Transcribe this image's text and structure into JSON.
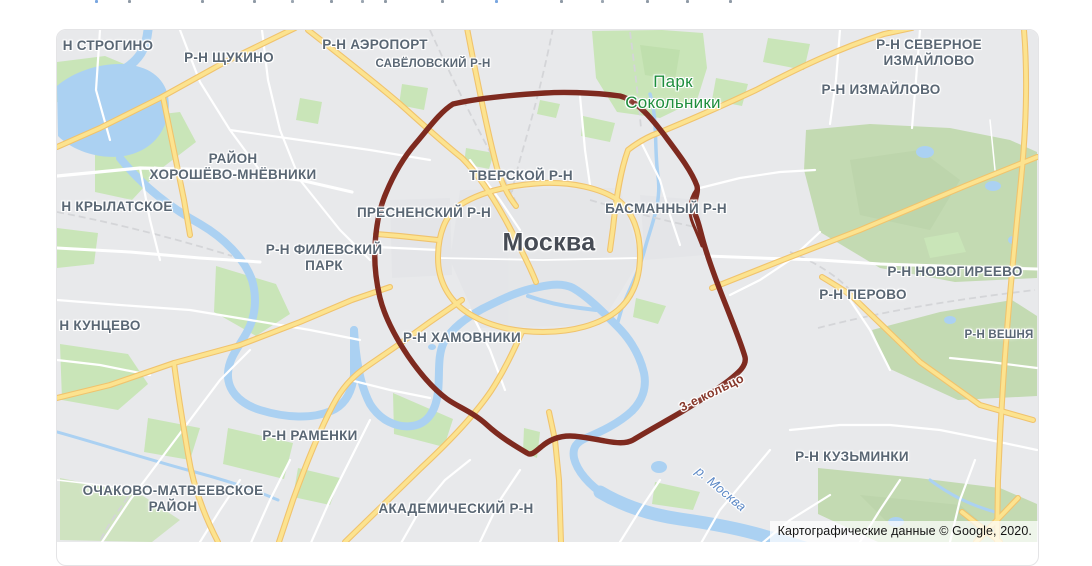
{
  "page": {
    "background": "#ffffff",
    "clipped_top_text_fragments": [
      {
        "x": 95,
        "color": "#79a6e0"
      },
      {
        "x": 128,
        "color": "#8e99a5"
      },
      {
        "x": 201,
        "color": "#8e99a5"
      },
      {
        "x": 253,
        "color": "#8e99a5"
      },
      {
        "x": 291,
        "color": "#9aa5b0"
      },
      {
        "x": 330,
        "color": "#8e99a5"
      },
      {
        "x": 361,
        "color": "#9aa5b0"
      },
      {
        "x": 384,
        "color": "#8e99a5"
      },
      {
        "x": 441,
        "color": "#8e99a5"
      },
      {
        "x": 495,
        "color": "#79a6e0"
      },
      {
        "x": 560,
        "color": "#8e99a5"
      },
      {
        "x": 601,
        "color": "#9aa5b0"
      },
      {
        "x": 646,
        "color": "#8e99a5"
      },
      {
        "x": 686,
        "color": "#8e99a5"
      },
      {
        "x": 729,
        "color": "#8e99a5"
      }
    ]
  },
  "map": {
    "attribution": "Картографические данные © Google, 2020.",
    "colors": {
      "land": "#e8e9eb",
      "water": "#abd1f2",
      "park": "#c9e5b8",
      "forest": "#c3dab2",
      "road_major_fill": "#fce38f",
      "road_major_casing": "#f0c36d",
      "road_minor": "#ffffff",
      "ring_road": "#7e2a1f",
      "district_label": "#5a6774",
      "city_label": "#474c55",
      "park_label": "#1f8e3d",
      "river_label": "#5d89c6",
      "ring_label": "#87382b"
    },
    "labels": [
      {
        "id": "strogino",
        "kind": "district",
        "x": 108,
        "y": 46,
        "lines": [
          "Н СТРОГИНО"
        ]
      },
      {
        "id": "shchukino",
        "kind": "district",
        "x": 229,
        "y": 58,
        "lines": [
          "Р-Н ЩУКИНО"
        ]
      },
      {
        "id": "aeroport",
        "kind": "district",
        "x": 375,
        "y": 45,
        "lines": [
          "Р-Н АЭРОПОРТ"
        ]
      },
      {
        "id": "savyolovsky",
        "kind": "small",
        "x": 433,
        "y": 65,
        "lines": [
          "САВЁЛОВСКИЙ Р-Н"
        ]
      },
      {
        "id": "severnoe-izmaylovo",
        "kind": "district",
        "x": 929,
        "y": 53,
        "lines": [
          "Р-Н СЕВЕРНОЕ",
          "ИЗМАЙЛОВО"
        ]
      },
      {
        "id": "izmaylovo",
        "kind": "district",
        "x": 881,
        "y": 90,
        "lines": [
          "Р-Н ИЗМАЙЛОВО"
        ]
      },
      {
        "id": "park-sokolniki",
        "kind": "park",
        "x": 673,
        "y": 92,
        "lines": [
          "Парк",
          "Сокольники"
        ]
      },
      {
        "id": "khoroshyovo-mnyovniki",
        "kind": "district",
        "x": 233,
        "y": 167,
        "lines": [
          "РАЙОН",
          "ХОРОШЁВО-МНЁВНИКИ"
        ]
      },
      {
        "id": "tverskoy",
        "kind": "district",
        "x": 521,
        "y": 176,
        "lines": [
          "ТВЕРСКОЙ Р-Н"
        ]
      },
      {
        "id": "krylatskoe",
        "kind": "district",
        "x": 117,
        "y": 207,
        "lines": [
          "Н КРЫЛАТСКОЕ"
        ]
      },
      {
        "id": "presnensky",
        "kind": "district",
        "x": 424,
        "y": 213,
        "lines": [
          "ПРЕСНЕНСКИЙ Р-Н"
        ]
      },
      {
        "id": "basmanny",
        "kind": "district",
        "x": 666,
        "y": 209,
        "lines": [
          "БАСМАННЫЙ Р-Н"
        ]
      },
      {
        "id": "moskva",
        "kind": "city",
        "x": 549,
        "y": 243,
        "lines": [
          "Москва"
        ]
      },
      {
        "id": "filyovsky-park",
        "kind": "district",
        "x": 324,
        "y": 258,
        "lines": [
          "Р-Н ФИЛЕВСКИЙ",
          "ПАРК"
        ]
      },
      {
        "id": "novogireevo",
        "kind": "district",
        "x": 955,
        "y": 272,
        "lines": [
          "Р-Н НОВОГИРЕЕВО"
        ]
      },
      {
        "id": "perovo",
        "kind": "district",
        "x": 863,
        "y": 295,
        "lines": [
          "Р-Н ПЕРОВО"
        ]
      },
      {
        "id": "veshnyaki",
        "kind": "small",
        "x": 999,
        "y": 336,
        "lines": [
          "Р-Н ВЕШНЯ"
        ]
      },
      {
        "id": "kuntsevo",
        "kind": "district",
        "x": 100,
        "y": 326,
        "lines": [
          "Н КУНЦЕВО"
        ]
      },
      {
        "id": "khamovniki",
        "kind": "district",
        "x": 462,
        "y": 338,
        "lines": [
          "Р-Н ХАМОВНИКИ"
        ]
      },
      {
        "id": "ramenki",
        "kind": "district",
        "x": 310,
        "y": 436,
        "lines": [
          "Р-Н РАМЕНКИ"
        ]
      },
      {
        "id": "kuzminki",
        "kind": "district",
        "x": 852,
        "y": 457,
        "lines": [
          "Р-Н КУЗЬМИНКИ"
        ]
      },
      {
        "id": "ochakovo-matveevskoe",
        "kind": "district",
        "x": 173,
        "y": 499,
        "lines": [
          "ОЧАКОВО-МАТВЕЕВСКОЕ",
          "РАЙОН"
        ]
      },
      {
        "id": "akademichesky",
        "kind": "district",
        "x": 456,
        "y": 509,
        "lines": [
          "АКАДЕМИЧЕСКИЙ Р-Н"
        ]
      },
      {
        "id": "third-ring-road",
        "kind": "road",
        "x": 712,
        "y": 393,
        "rot": -26,
        "lines": [
          "3-е кольцо"
        ]
      },
      {
        "id": "moskva-river",
        "kind": "river",
        "x": 721,
        "y": 489,
        "rot": 40,
        "lines": [
          "р. Москва"
        ]
      }
    ]
  }
}
